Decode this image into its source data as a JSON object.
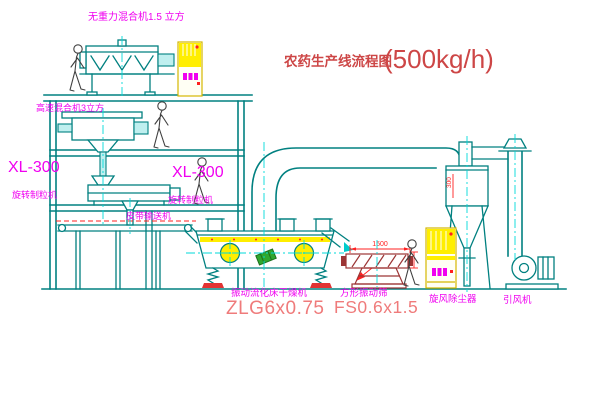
{
  "diagram": {
    "title": "农药生产线流程图",
    "title_capacity": "(500kg/h)"
  },
  "labels": {
    "gravity_free_mixer": "无重力混合机1.5 立方",
    "high_speed_mixer": "高速混合机3立方",
    "granulator_left_model": "XL-300",
    "granulator_left_name": "旋转制粒机",
    "granulator_center_model": "XL-300",
    "granulator_center_name": "旋转制粒机",
    "belt_conveyor": "皮带输送机",
    "fluid_bed_dryer": "振动流化床干燥机",
    "fluid_bed_dryer_model": "ZLG6x0.75",
    "square_sieve": "方形振动筛",
    "square_sieve_model": "FS0.6x1.5",
    "cyclone": "旋风除尘器",
    "induced_fan": "引风机"
  },
  "dimensions": {
    "sieve_length": "1500",
    "cyclone_duct": "300"
  },
  "colors": {
    "machine_line": "#008080",
    "centerline": "#00dada",
    "label_magenta": "#f000f0",
    "title_red": "#cd4646",
    "model_red": "#ef7b7b",
    "dimension_red": "#ff2020",
    "equipment_yellow": "#ffee00",
    "sieve_dark_red": "#9c3535",
    "motor_green": "#2fa82f"
  }
}
